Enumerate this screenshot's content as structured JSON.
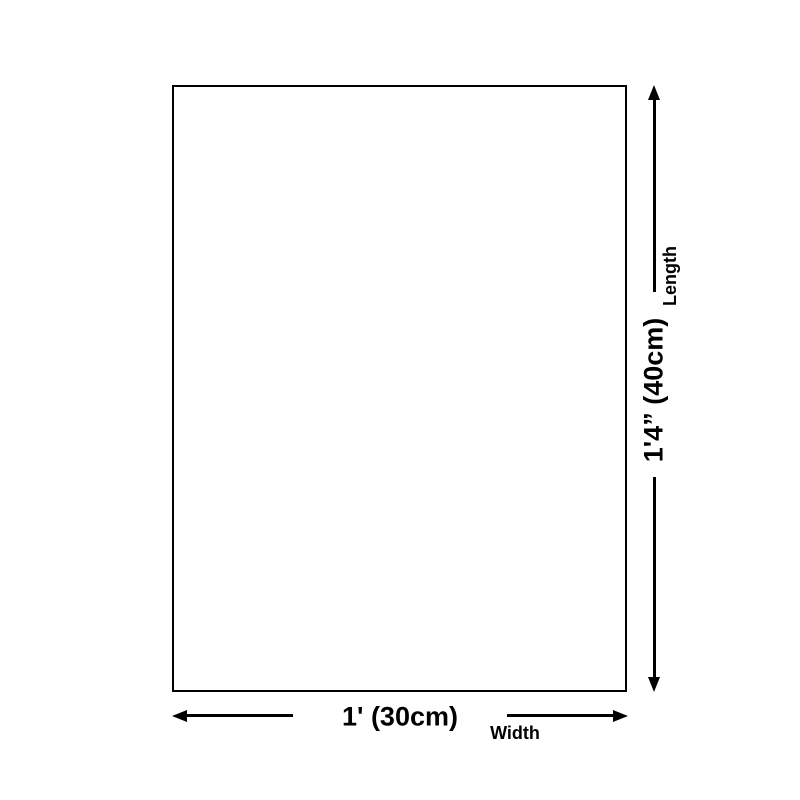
{
  "diagram": {
    "type": "product-dimension-diagram",
    "background_color": "#ffffff",
    "line_color": "#000000",
    "dimensions": {
      "length": {
        "label": "Length",
        "value": "1'4” (40cm)"
      },
      "width": {
        "label": "Width",
        "value": "1' (30cm)"
      }
    }
  }
}
